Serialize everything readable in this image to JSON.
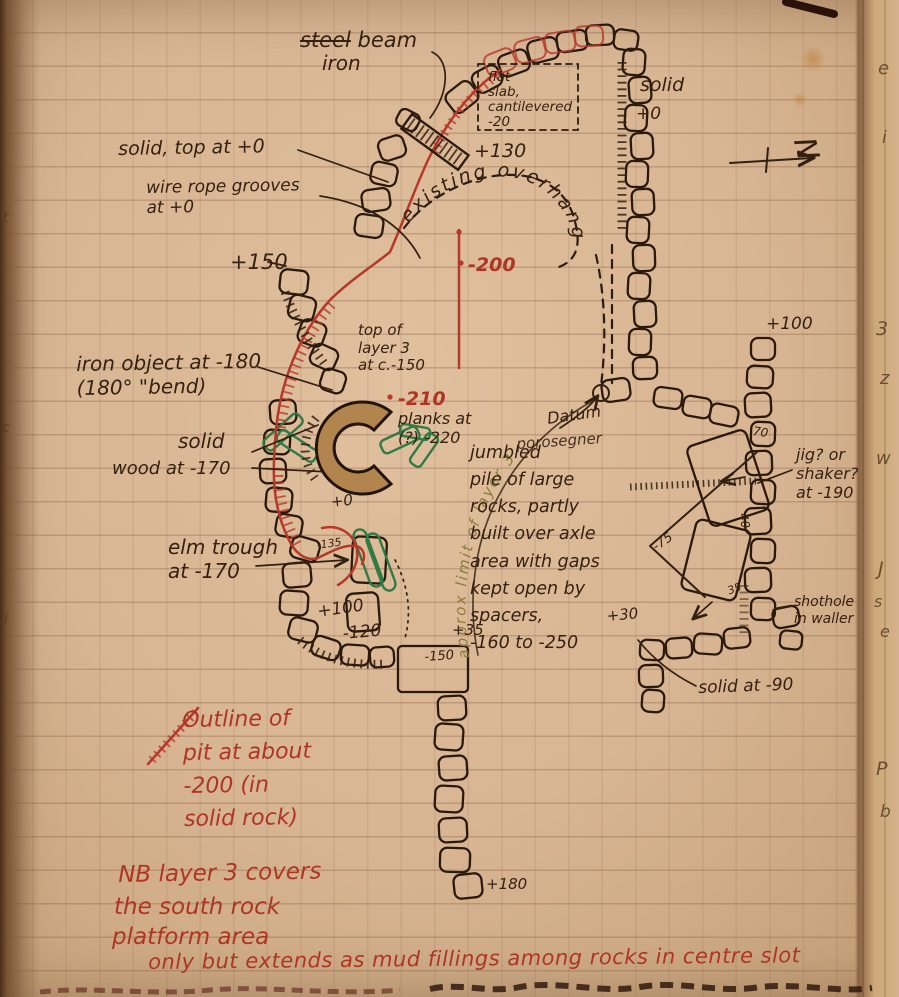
{
  "labels": {
    "steel": "steel",
    "beam": "beam",
    "iron": "iron",
    "flat_slab": "flat\nslab,\ncantilevered\n-20",
    "solid_right": "solid",
    "solid_right_level": "+0",
    "north": "N",
    "solid_top": "solid, top at +0",
    "wire_rope": "wire rope grooves\nat +0",
    "plus150": "+150",
    "overhang": "existing overhang",
    "plus130": "+130",
    "minus200": "-200",
    "layer3_top": "top of\nlayer 3\nat c.-150",
    "iron_object": "iron object at -180\n(180° \"bend)",
    "minus210": "-210",
    "planks": "planks at\n(?) -220",
    "solid_wood_1": "solid",
    "solid_wood_2": "wood at -170",
    "elm_trough": "elm trough\nat -170",
    "plus0": "+0",
    "minus135": "-135",
    "plus100_left": "+100",
    "minus120": "-120",
    "datum": "Datum",
    "datum_scribble": "porosegner",
    "jumbled": "jumbled\npile of large\nrocks, partly\nbuilt over axle\narea with gaps\nkept open by\n   spacers,\n -160 to -250",
    "approx_limit": "approx limit of layer 3",
    "plus35": "+35",
    "plus30": "+30",
    "minus150": "-150",
    "plus100_right": "+100",
    "num70": "70",
    "num40": "40",
    "num75": "-75",
    "num35": "35",
    "jig": "jig? or\nshaker?\nat -190",
    "shothole": "shothole\nin waller",
    "solid90": "solid at -90",
    "plus180": "+180",
    "outline_note": "Outline of\npit at about\n-200 (in\nsolid rock)",
    "nb1": "NB  layer 3 covers",
    "nb2": "the south rock",
    "nb3": "platform area",
    "nb4": "only but extends as mud fillings among rocks in centre slot"
  },
  "margin_right": [
    "e",
    "i",
    "3",
    "z",
    "w",
    "J",
    "s",
    "e",
    "P",
    "b"
  ],
  "margin_left": [
    "t",
    "c",
    "i"
  ],
  "colors": {
    "ink": "#36200f",
    "red_ink": "#ae3524",
    "green_ink": "#2f7a45",
    "olive_ink": "#8a7d3c",
    "paper": "#d8b593"
  }
}
